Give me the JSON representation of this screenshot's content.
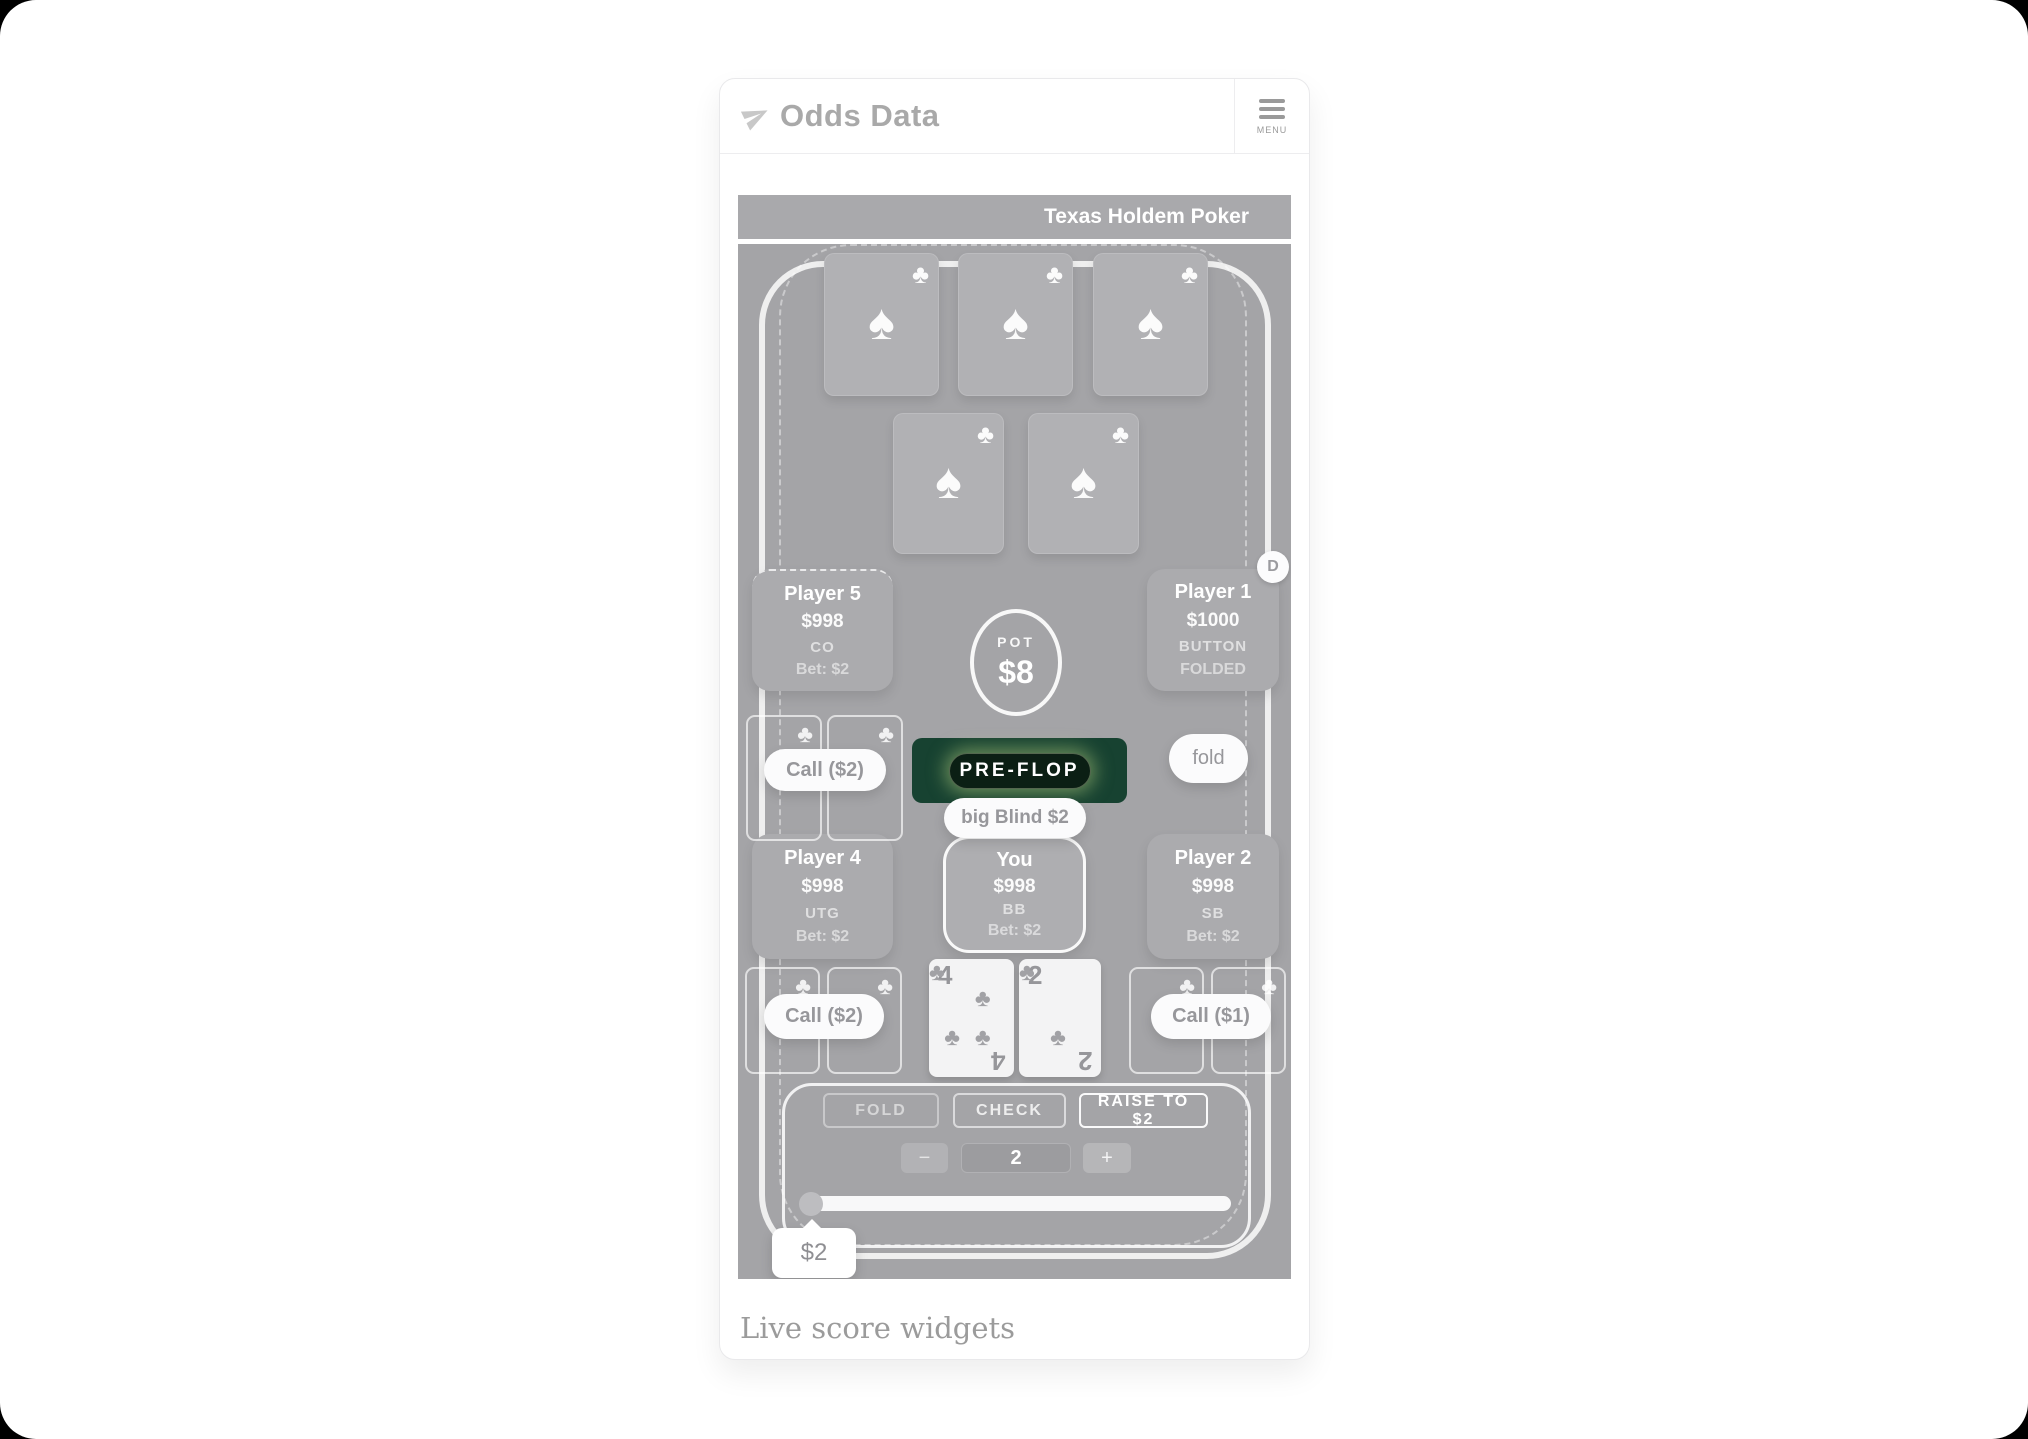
{
  "header": {
    "brand": "Odds Data",
    "menu_label": "MENU"
  },
  "game": {
    "title": "Texas Holdem Poker",
    "stage_badge": "PRE-FLOP",
    "pot": {
      "label": "POT",
      "amount": "$8"
    },
    "dealer_chip": "D",
    "players": [
      {
        "name": "Player 5",
        "stack": "$998",
        "position": "CO",
        "bet": "Bet: $2"
      },
      {
        "name": "Player 1",
        "stack": "$1000",
        "position": "BUTTON",
        "status": "FOLDED"
      },
      {
        "name": "Player 4",
        "stack": "$998",
        "position": "UTG",
        "bet": "Bet: $2"
      },
      {
        "name": "You",
        "stack": "$998",
        "position": "BB",
        "bet": "Bet: $2"
      },
      {
        "name": "Player 2",
        "stack": "$998",
        "position": "SB",
        "bet": "Bet: $2"
      }
    ],
    "pills": {
      "call_top_left": "Call ($2)",
      "fold": "fold",
      "big_blind": "big Blind $2",
      "call_bottom_left": "Call ($2)",
      "call_bottom_right": "Call ($1)"
    },
    "hole_cards": [
      {
        "rank": "4",
        "suit": "clubs"
      },
      {
        "rank": "2",
        "suit": "clubs"
      }
    ],
    "controls": {
      "fold": "FOLD",
      "check": "CHECK",
      "raise": "RAISE TO $2",
      "minus": "−",
      "bet_value": "2",
      "plus": "+",
      "slider_tooltip": "$2"
    }
  },
  "icons": {
    "club": "♣",
    "spade": "♠"
  },
  "footer": {
    "label": "Live score widgets"
  },
  "colors": {
    "stage_outer": "#174231",
    "stage_inner": "#0b1f14",
    "stage_glow": "#c4de86",
    "table_gray": "#a4a4a7",
    "titlebar_gray": "#a9a9ac"
  }
}
